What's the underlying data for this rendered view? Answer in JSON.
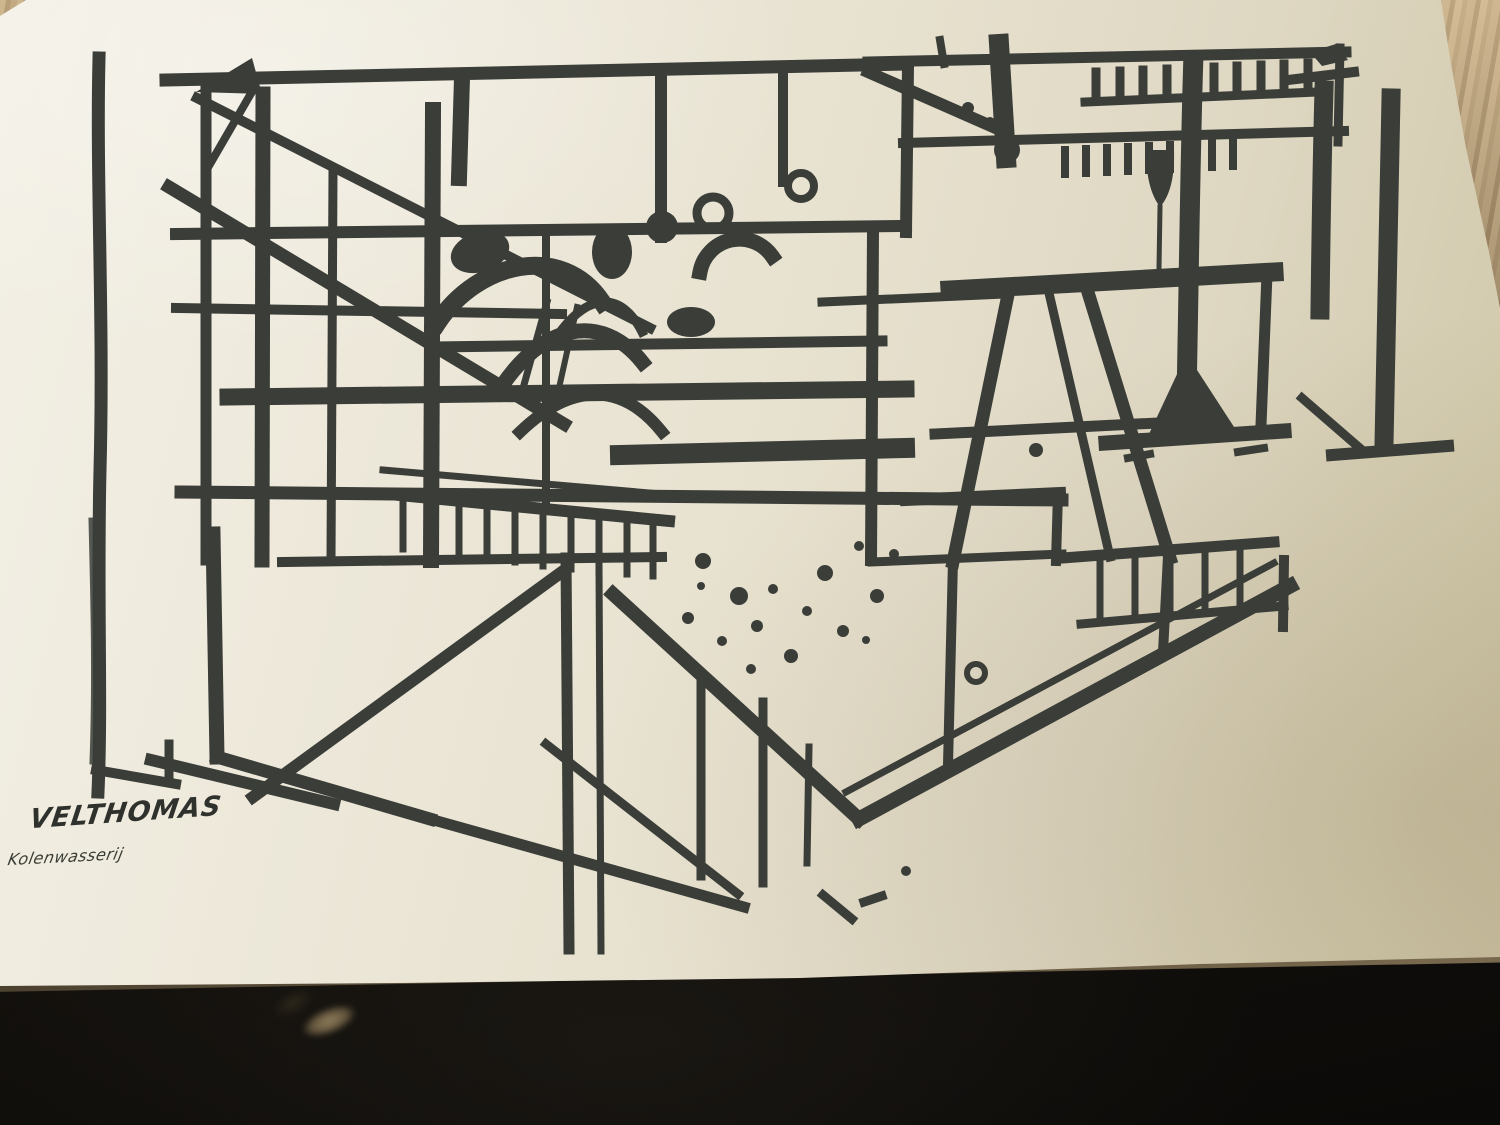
{
  "photo": {
    "scene": "Photograph of a black brush-ink print on a cream book page lying on a wooden table, dark foreground below the page",
    "artwork": {
      "signature": "VELTHOMAS",
      "caption": "Kolenwasserij",
      "subject": "Abstract industrial coal-washery structure rendered in bold black brush strokes"
    },
    "colors": {
      "paper": "#E9E4D3",
      "ink": "#3A3D38",
      "wood_table": "#B79D79",
      "backdrop": "#14120F"
    }
  }
}
